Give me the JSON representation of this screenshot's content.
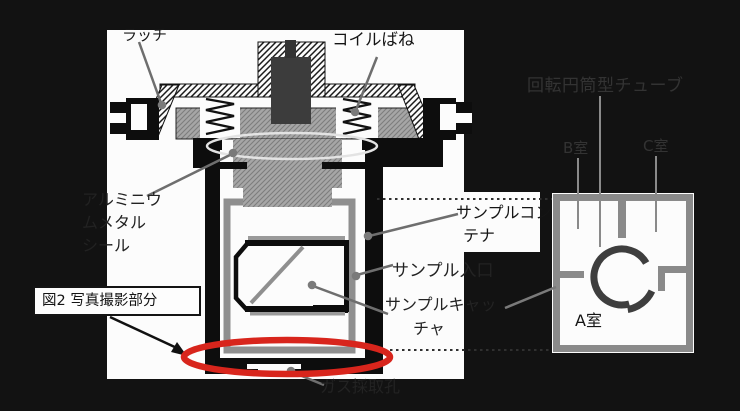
{
  "figure": {
    "caption": "図2 写真撮影部分",
    "type": "technical cross-section diagram of a sample container with rotary cylindrical tube"
  },
  "labels": {
    "latch": "ラッチ",
    "coil_spring": "コイルばね",
    "aluminum_seal_line1": "アルミニウ",
    "aluminum_seal_line2": "ムメタル",
    "aluminum_seal_line3": "シール",
    "sample_container_line1": "サンプルコン",
    "sample_container_line2": "テナ",
    "sample_inlet": "サンプル入口",
    "sample_catcher_line1": "サンプルキャッ",
    "sample_catcher_line2": "チャ",
    "gas_sampling_hole": "ガス採取孔",
    "rotating_tube": "回転円筒型チューブ",
    "chamber_a": "A室",
    "chamber_b": "B室",
    "chamber_c": "C室"
  },
  "colors": {
    "background_black": "#121212",
    "panel_white": "#fcfcfc",
    "highlight_red": "#d8251c",
    "metal_gray": "#a6a6a6",
    "leader_line_gray": "#6e6e6e",
    "ring_gray": "#3e3e3e",
    "ink_black": "#0d0d0d"
  }
}
